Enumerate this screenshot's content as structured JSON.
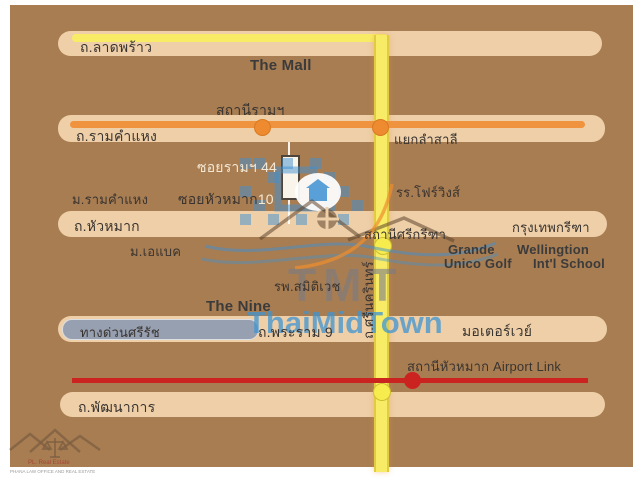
{
  "map": {
    "roads": {
      "lat_phrao": {
        "label": "ถ.ลาดพร้าว"
      },
      "ramkhamhaeng": {
        "label": "ถ.รามคำแหง"
      },
      "hua_mak": {
        "label": "ถ.หัวหมาก"
      },
      "krungthep_kreetha": {
        "label": "กรุงเทพกรีฑา"
      },
      "rama9": {
        "label": "ถ.พระราม 9"
      },
      "motorway": {
        "label": "มอเตอร์เวย์"
      },
      "phatthanakan": {
        "label": "ถ.พัฒนาการ"
      },
      "srinagarindra": {
        "label": "ถ.ศรีนครินทร์"
      },
      "expressway": {
        "label": "ทางด่วนศรีรัช"
      },
      "soi_ram_44": {
        "label": "ซอยรามฯ 44"
      },
      "soi_hua_mak_10": {
        "label": "ซอยหัวหมาก",
        "number": "10"
      }
    },
    "stations": {
      "ram_station": "สถานีรามฯ",
      "lam_sali_intersection": "แยกลำสาลี",
      "si_kritha_station": "สถานีศรีกรีฑา",
      "hua_mak_airport_link": "สถานีหัวหมาก Airport Link"
    },
    "places": {
      "the_mall": "The Mall",
      "ramkhamhaeng_university": "ม.รามคำแหง",
      "abac_university": "ม.เอแบค",
      "four_wings": "รร.โฟร์วิงส์",
      "grande": "Grande",
      "wellingtion": "Wellingtion",
      "unico_golf": "Unico Golf",
      "intl_school": "Int'l School",
      "samitivej_hospital": "รพ.สมิติเวช",
      "the_nine": "The Nine"
    },
    "watermark": {
      "tmt": "TMT",
      "thaimidtown": "ThaiMidTown"
    },
    "corner_logo": {
      "line1": "PL. Real Estate",
      "line2": "PHANA LAW OFFICE AND REAL ESTATE"
    },
    "colors": {
      "background": "#a87d52",
      "road_band": "#eecfa8",
      "yellow_road": "#f8ec67",
      "orange_road": "#f0933e",
      "red_airport_link": "#cb2420",
      "expressway_gray": "#97a0b0",
      "watermark_blue": "#3e90d2"
    }
  }
}
